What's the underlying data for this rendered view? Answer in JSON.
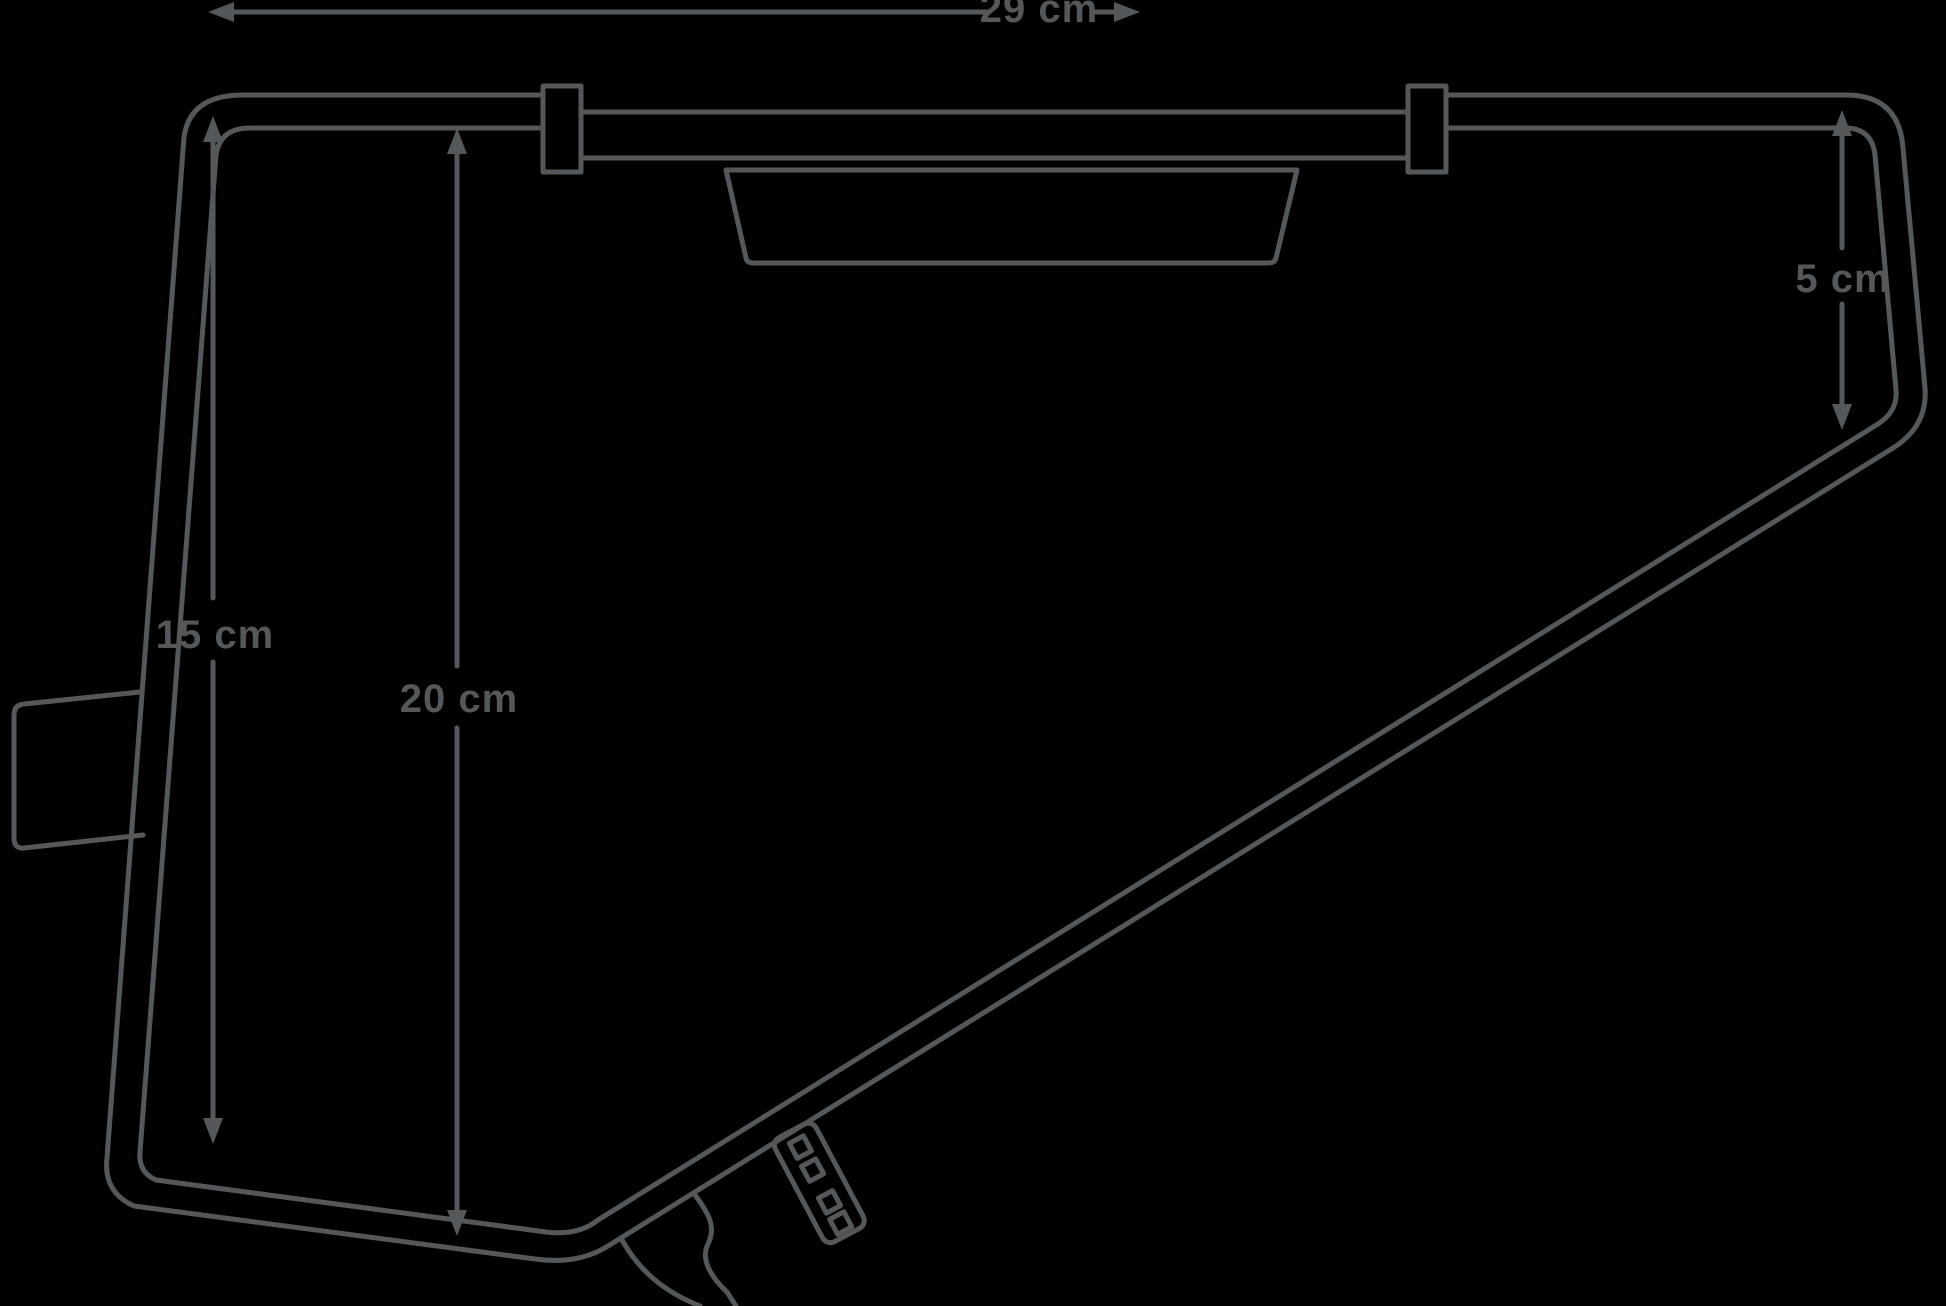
{
  "diagram": {
    "title": "frame-bag-dimension-diagram",
    "background_color": "#000000",
    "line_color": "#54585b",
    "dimensions": {
      "top_width": "29 cm",
      "left_height": "15 cm",
      "middle_height": "20 cm",
      "right_height": "5 cm"
    }
  }
}
